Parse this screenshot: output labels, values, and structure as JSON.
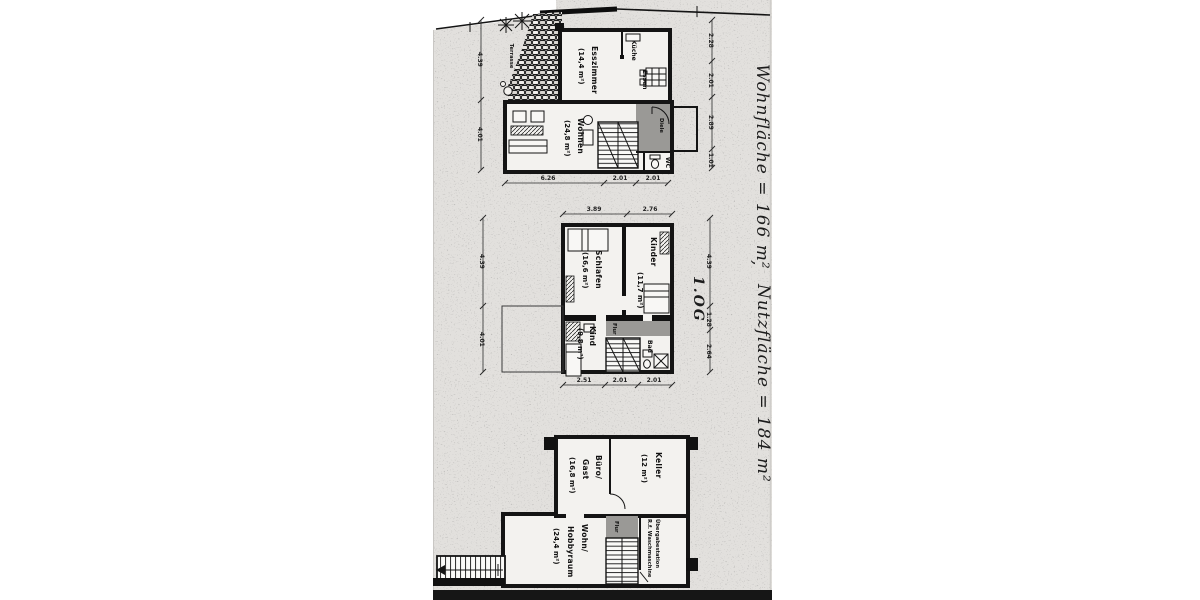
{
  "scan": {
    "annotations": {
      "wohnflaeche": "Wohnfläche = 166 m²",
      "separator": ",",
      "nutzflaeche": "Nutzfläche = 184 m²"
    },
    "floors": {
      "eg": {
        "rooms": {
          "esszimmer": {
            "name": "Esszimmer",
            "area": "(14,4 m²)"
          },
          "kueche": {
            "name": "Küche"
          },
          "essen": {
            "name": "Essen"
          },
          "wohnen": {
            "name": "Wohnen",
            "area": "(24,8 m²)"
          },
          "diele": {
            "name": "Diele"
          },
          "wc": {
            "name": "WC"
          },
          "terrasse": {
            "name": "Terrasse"
          }
        },
        "dims": {
          "left": [
            "4.39",
            "4.01"
          ],
          "right": [
            "2.28",
            "2.01",
            "2.89",
            "1.01"
          ],
          "bottom": [
            "6.26",
            "2.01",
            "2.01"
          ]
        }
      },
      "og": {
        "label": "1.OG",
        "rooms": {
          "schlafen": {
            "name": "Schlafen",
            "area": "(16,6 m²)"
          },
          "kinder": {
            "name": "Kinder",
            "area": "(11,7 m²)"
          },
          "kind": {
            "name": "Kind",
            "area": "(9,8 m²)"
          },
          "bad": {
            "name": "Bad"
          },
          "flur": {
            "name": "Flur"
          }
        },
        "dims": {
          "top": [
            "3.89",
            "2.76"
          ],
          "left": [
            "4.39",
            "4.01"
          ],
          "right": [
            "4.39",
            "1.28",
            "2.64"
          ],
          "bottom": [
            "2.51",
            "2.01",
            "2.01"
          ]
        }
      },
      "ug": {
        "rooms": {
          "buero": {
            "line1": "Büro/",
            "line2": "Gast",
            "area": "(16,8 m²)"
          },
          "keller": {
            "name": "Keller",
            "area": "(12 m²)"
          },
          "wohnraum": {
            "line1": "Wohn/",
            "line2": "Hobbyraum",
            "area": "(24,4 m²)"
          },
          "flur": {
            "name": "Flur"
          },
          "uebergabe": {
            "line1": "Übergabestation",
            "line2": "R.f. Waschmaschine"
          }
        }
      }
    }
  }
}
